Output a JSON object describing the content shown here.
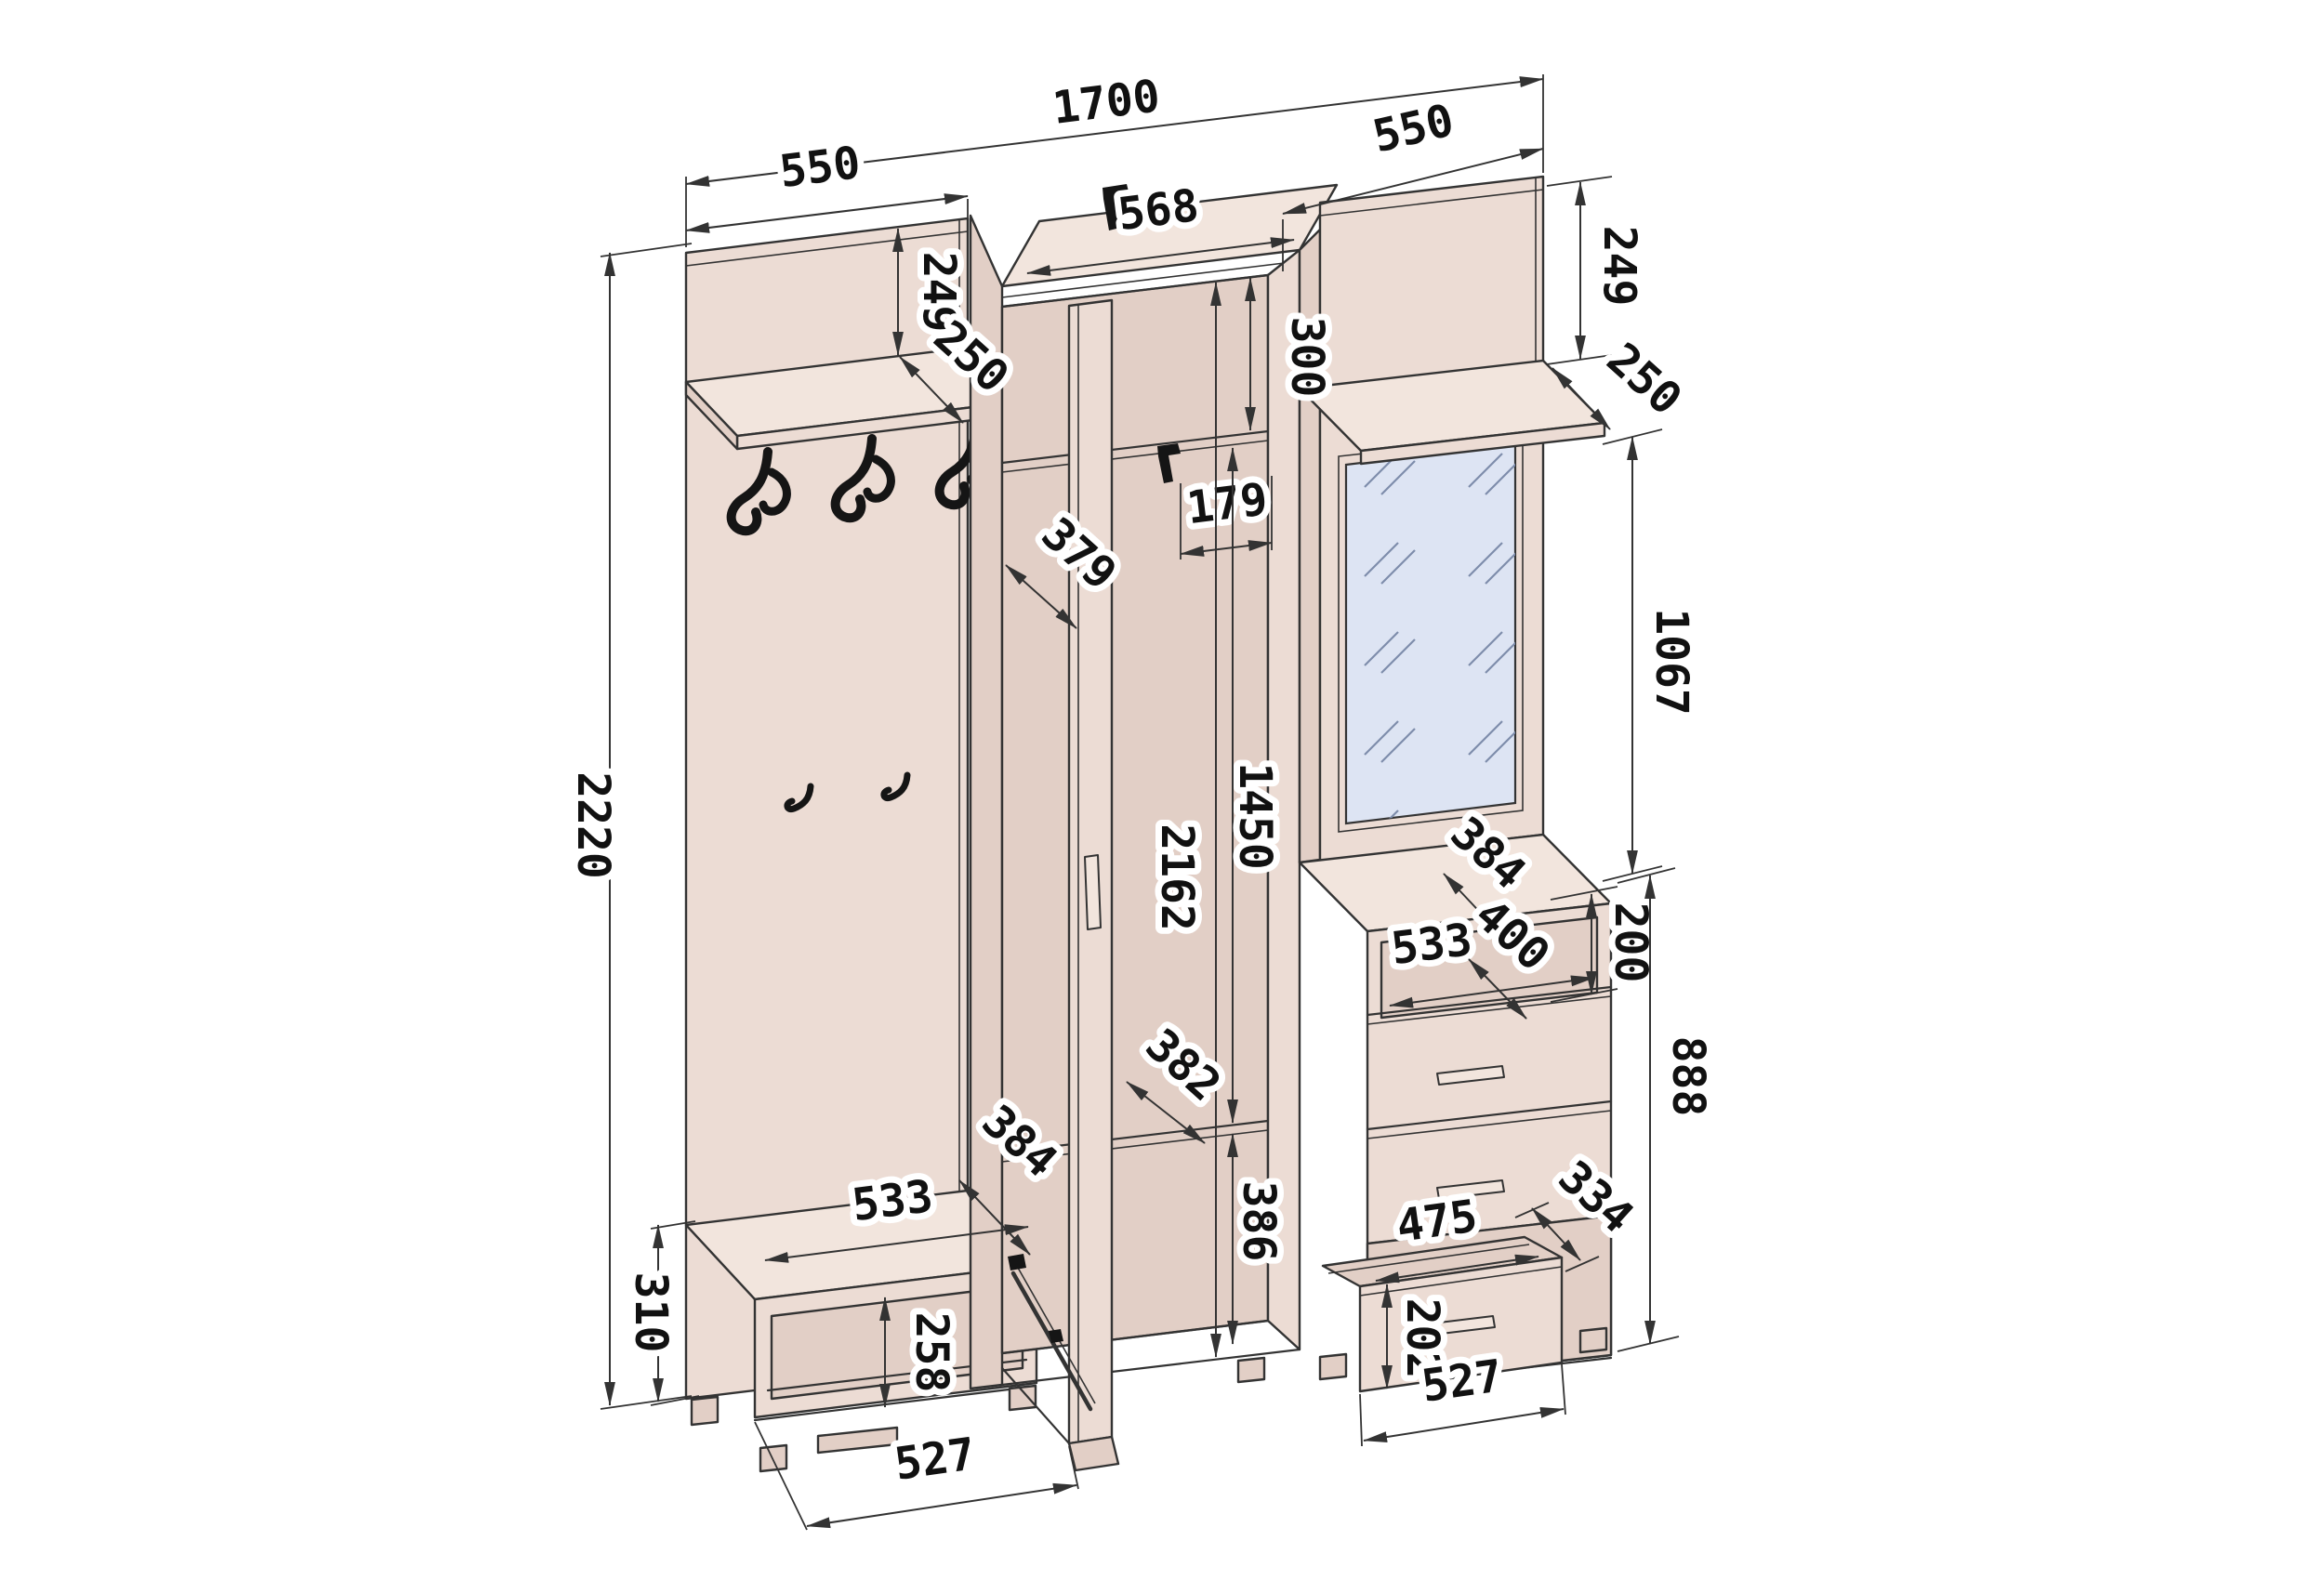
{
  "drawing": {
    "colors": {
      "bg": "#ffffff",
      "face": "#ecdcd4",
      "faceLight": "#f2e5dd",
      "faceDark": "#e2cfc6",
      "line": "#333333",
      "mirror": "#dde4f3",
      "hatch": "#7e8dab",
      "icon": "#151515",
      "label": "#111111"
    },
    "dimensions": {
      "overall_width": "1700",
      "overall_height": "2220",
      "left_section_width": "550",
      "right_section_width": "550",
      "wardrobe_top_width": "568",
      "left_shelf_offset": "249",
      "left_shelf_depth": "250",
      "right_shelf_offset": "249",
      "right_shelf_depth": "250",
      "top_shelf_height": "300",
      "rod_clearance": "179",
      "side_panel_depth": "379",
      "mirror_section_height": "1067",
      "wardrobe_inner_height": "2162",
      "door_inner_height": "1450",
      "wardrobe_shelf_depth": "382",
      "wardrobe_base_height": "386",
      "bench_depth": "384",
      "bench_top_width": "533",
      "bench_height": "310",
      "bench_opening_height": "258",
      "bench_base_width": "527",
      "chest_depth": "384",
      "chest_shelf_width": "533",
      "chest_shelf_depth": "400",
      "chest_niche_height": "200",
      "chest_height": "888",
      "drawer_opening_width": "475",
      "drawer_depth": "334",
      "drawer_front_height": "202",
      "drawer_width": "527"
    }
  }
}
